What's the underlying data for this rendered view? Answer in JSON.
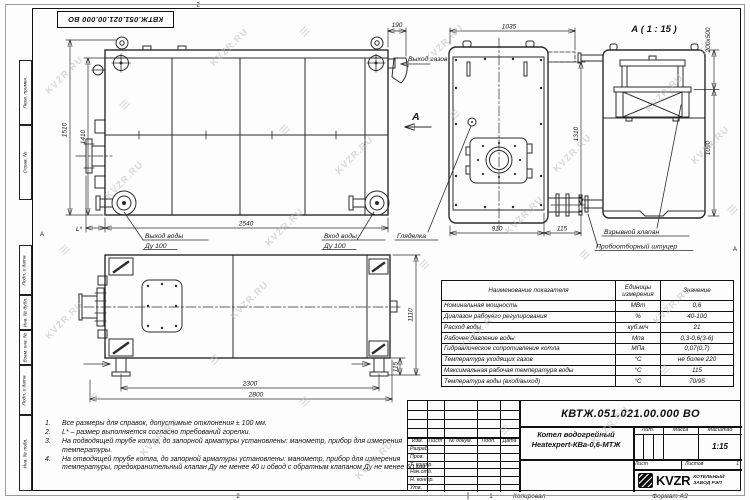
{
  "doc": {
    "number": "КВТЖ.051.021.00.000 ВО",
    "product_name_line1": "Котел водогрейный",
    "product_name_line2": "Heatexpert-КВа-0,6-МТЖ",
    "scale_value": "1:15",
    "lit_label": "Лит.",
    "mass_label": "Масса",
    "scale_label": "Масштаб",
    "sheet_label": "Лист",
    "sheets_label": "Листов",
    "sheets_value": "1",
    "copied_label": "Копировал",
    "format_label": "Формат А3"
  },
  "company": {
    "logo_text": "KVZR",
    "name_line1": "КОТЕЛЬНЫЙ",
    "name_line2": "ЗАВОД РЭП"
  },
  "watermark": {
    "text": "KVZR.RU",
    "logo_glyph": "≡"
  },
  "frame": {
    "left_labels": [
      "Перв. примен.",
      "Справ. №",
      "Подп. и дата",
      "Инв. № дубл.",
      "Взам. инв. №",
      "Подп. и дата",
      "Инв. № подл."
    ],
    "zone_top": "2",
    "zone_bottom": "2",
    "zone_sheet": "1",
    "zone_left": "А",
    "zone_right": "А"
  },
  "title_block": {
    "revision_header": [
      "Изм.",
      "Лист",
      "№ докум.",
      "Подп.",
      "Дата"
    ],
    "roles": [
      "Разраб.",
      "Пров.",
      "Т. контр.",
      "Нач.отд.",
      "Н. контр.",
      "Утв."
    ]
  },
  "spec_table": {
    "col1": "Наименование показателя",
    "col2_line1": "Единицы",
    "col2_line2": "измерения",
    "col3": "Значение",
    "rows": [
      [
        "Номинальная мощность",
        "МВт",
        "0,6"
      ],
      [
        "Диапазон рабочего регулирования",
        "%",
        "40-100"
      ],
      [
        "Расход воды",
        "куб.м/ч",
        "21"
      ],
      [
        "Рабочее давление воды",
        "Мпа",
        "0,3-0,6(3-6)"
      ],
      [
        "Гидравлическое сопротивление котла",
        "МПа",
        "0,07(0,7)"
      ],
      [
        "Температура уходящих газов",
        "°С",
        "не более 220"
      ],
      [
        "Максимальная рабочая температура воды",
        "°С",
        "115"
      ],
      [
        "Температура воды (вход/выход)",
        "°С",
        "70/95"
      ]
    ]
  },
  "notes": [
    {
      "num": "1.",
      "text": "Все размеры для справок, допустимые отклонения ± 100 мм."
    },
    {
      "num": "2.",
      "text": "L* – размер выполняется согласно требований горелки."
    },
    {
      "num": "3.",
      "text": "На подводящей трубе котла, до запорной арматуры установлены: манометр, прибор для измерения температуры."
    },
    {
      "num": "4.",
      "text": "На отводящей трубе котла, до запорной арматуры установлены: манометр, прибор для измерения температуры, предохранительный клапан Ду не менее 40 и обвод с обратным клапаном Ду не менее 50 мм."
    }
  ],
  "views": {
    "front": {
      "dim_height_outer": "1510",
      "dim_height_inner": "1410",
      "dim_length": "2540",
      "dim_l_star": "L*",
      "dim_gas_offset": "190",
      "label_gas_out": "Выход газов",
      "label_water_out": "Выход воды",
      "label_water_out_dn": "Ду 100",
      "label_water_in": "Вход воды",
      "label_water_in_dn": "Ду 100",
      "view_arrow": "А"
    },
    "side": {
      "dim_width_top": "1035",
      "dim_height": "1310",
      "dim_width_bottom": "910",
      "dim_depth": "115",
      "label_sight_glass": "Гляделка"
    },
    "detail": {
      "title": "А ( 1 : 15 )",
      "dim_flange": "200х500",
      "dim_height": "1090",
      "label_explosion_valve": "Взрывной клапан",
      "label_sampling_fitting": "Пробоотборный штуцер"
    },
    "bottom": {
      "dim_between_legs": "2300",
      "dim_total": "2800",
      "dim_height": "1110",
      "dim_leg": "115"
    }
  }
}
